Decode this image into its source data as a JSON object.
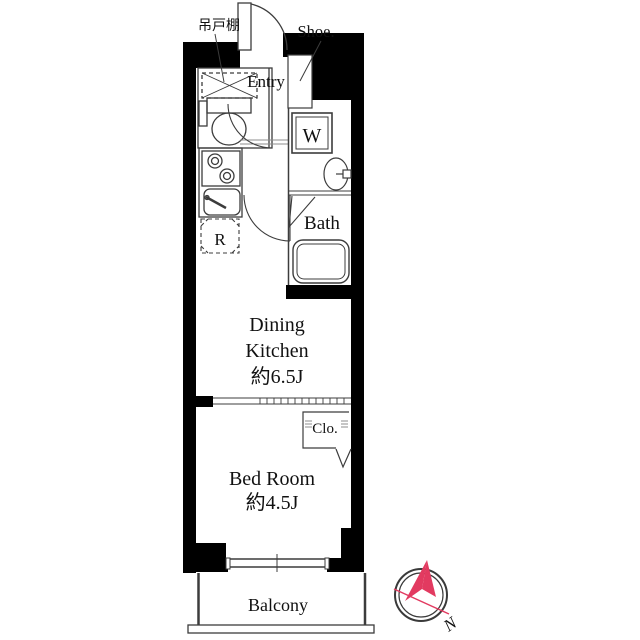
{
  "plan": {
    "labels": {
      "hanging_cupboard": "吊戸棚",
      "shoe": "Shoe.",
      "entry": "Entry",
      "washer": "W",
      "bath": "Bath",
      "refrigerator": "R",
      "closet": "Clo.",
      "balcony": "Balcony"
    },
    "rooms": {
      "dining_kitchen": {
        "name_line1": "Dining",
        "name_line2": "Kitchen",
        "size": "約6.5J"
      },
      "bed_room": {
        "name": "Bed Room",
        "size": "約4.5J"
      }
    },
    "compass": {
      "north": "N"
    },
    "fixtures": [
      "toilet-icon",
      "hanging-cupboard-icon",
      "shoe-cabinet-icon",
      "stove-icon",
      "kitchen-sink-icon",
      "washing-machine-icon",
      "washbasin-icon",
      "bathtub-icon",
      "sliding-door",
      "window",
      "closet-door",
      "compass-icon"
    ]
  },
  "colors": {
    "wall": "#000000",
    "line": "#3c3c3c",
    "light_line": "#8c8c8c",
    "text": "#111111",
    "compass_red": "#e23a60"
  }
}
